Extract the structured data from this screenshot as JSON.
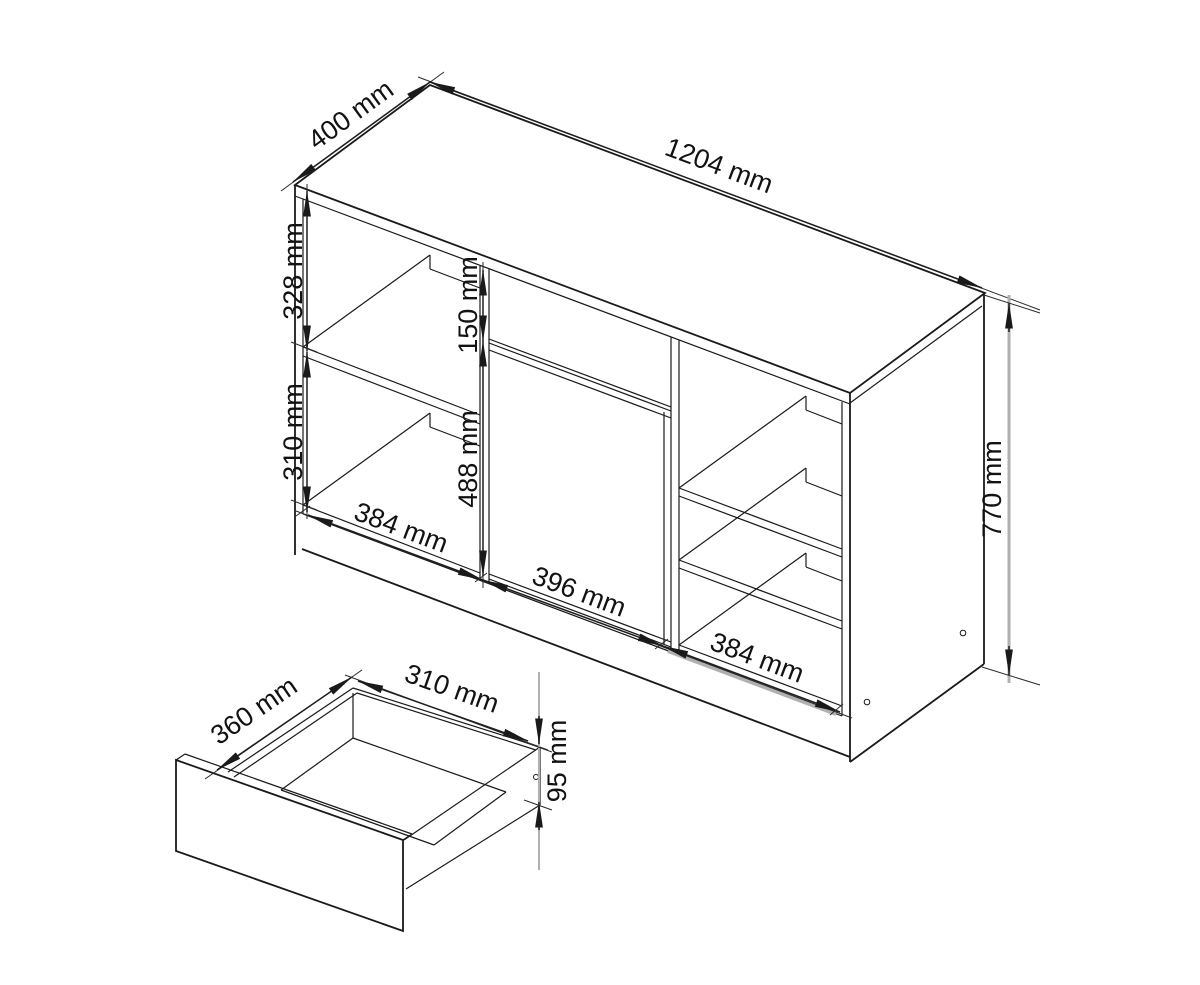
{
  "drawing": {
    "background": "#ffffff",
    "line_color": "#1a1a1a",
    "unit": "mm",
    "cabinet": {
      "description": "sideboard isometric line drawing with open shelves, drawer front and door",
      "dimensions": {
        "top_depth": "400 mm",
        "top_width": "1204 mm",
        "left_upper_section": "328 mm",
        "left_lower_section": "310 mm",
        "drawer_front_height": "150 mm",
        "door_height": "488 mm",
        "bottom_left_width": "384 mm",
        "bottom_middle_width": "396 mm",
        "bottom_right_width": "384 mm",
        "side_height": "770 mm"
      }
    },
    "drawer": {
      "description": "open drawer box detail view",
      "dimensions": {
        "depth": "360 mm",
        "width": "310 mm",
        "side_height": "95 mm"
      }
    }
  }
}
